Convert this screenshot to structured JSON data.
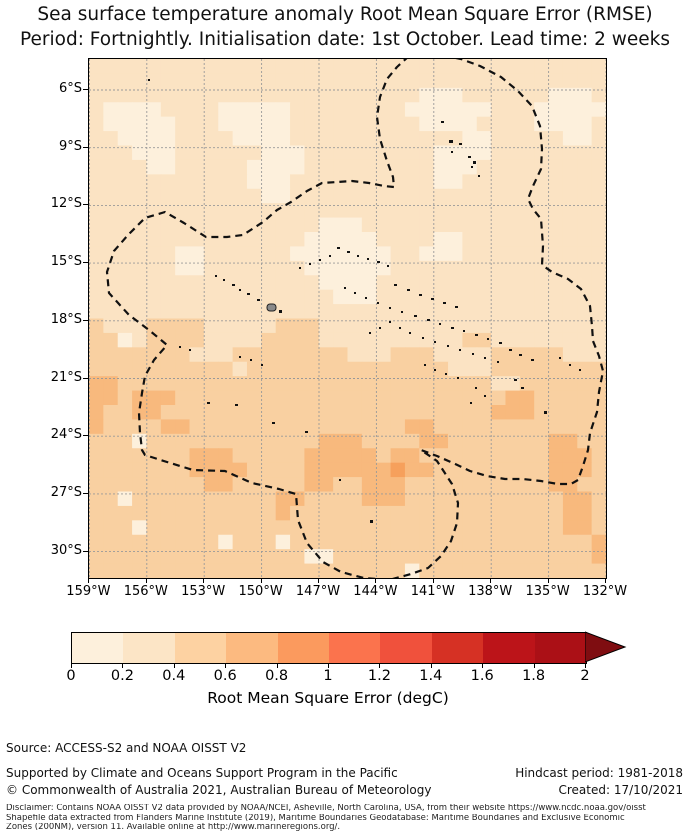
{
  "title": {
    "line1": "Sea surface temperature anomaly Root Mean Square Error (RMSE)",
    "line2": "Period: Fortnightly. Initialisation date: 1st October. Lead time: 2 weeks"
  },
  "map": {
    "y_ticks": [
      "6°S",
      "9°S",
      "12°S",
      "15°S",
      "18°S",
      "21°S",
      "24°S",
      "27°S",
      "30°S"
    ],
    "x_ticks": [
      "159°W",
      "156°W",
      "153°W",
      "150°W",
      "147°W",
      "144°W",
      "141°W",
      "138°W",
      "135°W",
      "132°W"
    ],
    "grid_color": "#999999",
    "border_color": "#000000",
    "island_color": "#111111",
    "tahiti": [
      178,
      245,
      9,
      7
    ],
    "tahiti_color": "#8a8a8a",
    "eez_dash_color": "#111111",
    "islands": [
      [
        59,
        20,
        2,
        2
      ],
      [
        352,
        62,
        3,
        2
      ],
      [
        360,
        81,
        4,
        3
      ],
      [
        370,
        84,
        3,
        2
      ],
      [
        362,
        92,
        2,
        2
      ],
      [
        379,
        97,
        3,
        2
      ],
      [
        384,
        102,
        3,
        3
      ],
      [
        382,
        107,
        2,
        2
      ],
      [
        389,
        116,
        2,
        2
      ],
      [
        248,
        188,
        3,
        2
      ],
      [
        258,
        192,
        3,
        2
      ],
      [
        268,
        196,
        2,
        2
      ],
      [
        278,
        199,
        2,
        2
      ],
      [
        288,
        202,
        3,
        2
      ],
      [
        298,
        206,
        2,
        2
      ],
      [
        240,
        196,
        2,
        2
      ],
      [
        230,
        200,
        2,
        2
      ],
      [
        220,
        204,
        2,
        2
      ],
      [
        210,
        208,
        2,
        2
      ],
      [
        126,
        216,
        2,
        2
      ],
      [
        134,
        220,
        2,
        2
      ],
      [
        143,
        225,
        3,
        2
      ],
      [
        150,
        230,
        2,
        2
      ],
      [
        158,
        234,
        3,
        2
      ],
      [
        168,
        240,
        3,
        2
      ],
      [
        190,
        251,
        3,
        3
      ],
      [
        305,
        225,
        3,
        2
      ],
      [
        318,
        230,
        3,
        2
      ],
      [
        330,
        235,
        3,
        2
      ],
      [
        342,
        239,
        3,
        2
      ],
      [
        354,
        243,
        3,
        2
      ],
      [
        366,
        247,
        3,
        2
      ],
      [
        255,
        228,
        2,
        2
      ],
      [
        265,
        233,
        2,
        2
      ],
      [
        276,
        238,
        2,
        2
      ],
      [
        288,
        243,
        2,
        2
      ],
      [
        300,
        248,
        2,
        2
      ],
      [
        312,
        252,
        2,
        2
      ],
      [
        325,
        256,
        3,
        2
      ],
      [
        338,
        260,
        3,
        2
      ],
      [
        350,
        264,
        2,
        2
      ],
      [
        362,
        268,
        3,
        2
      ],
      [
        374,
        271,
        2,
        2
      ],
      [
        386,
        275,
        3,
        2
      ],
      [
        398,
        279,
        2,
        2
      ],
      [
        410,
        283,
        3,
        2
      ],
      [
        300,
        262,
        2,
        2
      ],
      [
        290,
        268,
        2,
        2
      ],
      [
        280,
        273,
        2,
        2
      ],
      [
        310,
        268,
        2,
        2
      ],
      [
        320,
        273,
        2,
        2
      ],
      [
        333,
        278,
        2,
        2
      ],
      [
        345,
        282,
        2,
        2
      ],
      [
        358,
        286,
        2,
        2
      ],
      [
        370,
        290,
        2,
        2
      ],
      [
        383,
        294,
        2,
        2
      ],
      [
        395,
        298,
        2,
        2
      ],
      [
        408,
        302,
        2,
        2
      ],
      [
        420,
        290,
        3,
        2
      ],
      [
        430,
        295,
        3,
        2
      ],
      [
        442,
        300,
        3,
        2
      ],
      [
        161,
        300,
        2,
        2
      ],
      [
        172,
        305,
        2,
        2
      ],
      [
        150,
        297,
        2,
        2
      ],
      [
        100,
        290,
        2,
        2
      ],
      [
        90,
        287,
        2,
        2
      ],
      [
        480,
        305,
        2,
        2
      ],
      [
        490,
        310,
        2,
        2
      ],
      [
        470,
        298,
        2,
        2
      ],
      [
        345,
        310,
        2,
        2
      ],
      [
        356,
        314,
        2,
        2
      ],
      [
        335,
        305,
        2,
        2
      ],
      [
        368,
        318,
        2,
        2
      ],
      [
        425,
        320,
        3,
        2
      ],
      [
        432,
        328,
        3,
        2
      ],
      [
        386,
        328,
        2,
        2
      ],
      [
        395,
        336,
        2,
        2
      ],
      [
        381,
        343,
        2,
        2
      ],
      [
        455,
        352,
        3,
        3
      ],
      [
        118,
        343,
        3,
        2
      ],
      [
        146,
        345,
        3,
        2
      ],
      [
        183,
        363,
        3,
        2
      ],
      [
        216,
        372,
        3,
        2
      ],
      [
        281,
        461,
        3,
        3
      ],
      [
        250,
        420,
        2,
        2
      ]
    ],
    "eez_boundary": [
      [
        320,
        -3
      ],
      [
        308,
        8
      ],
      [
        298,
        20
      ],
      [
        291,
        38
      ],
      [
        288,
        58
      ],
      [
        291,
        80
      ],
      [
        298,
        102
      ],
      [
        304,
        118
      ],
      [
        305,
        128
      ],
      [
        295,
        127
      ],
      [
        280,
        124
      ],
      [
        263,
        122
      ],
      [
        248,
        123
      ],
      [
        233,
        124
      ],
      [
        218,
        132
      ],
      [
        202,
        143
      ],
      [
        188,
        151
      ],
      [
        174,
        163
      ],
      [
        154,
        176
      ],
      [
        138,
        178
      ],
      [
        117,
        178
      ],
      [
        95,
        164
      ],
      [
        76,
        153
      ],
      [
        56,
        159
      ],
      [
        39,
        176
      ],
      [
        25,
        192
      ],
      [
        18,
        213
      ],
      [
        20,
        234
      ],
      [
        40,
        256
      ],
      [
        60,
        271
      ],
      [
        78,
        286
      ],
      [
        65,
        301
      ],
      [
        56,
        317
      ],
      [
        53,
        334
      ],
      [
        50,
        354
      ],
      [
        51,
        374
      ],
      [
        53,
        391
      ],
      [
        56,
        396
      ],
      [
        78,
        403
      ],
      [
        104,
        411
      ],
      [
        136,
        412
      ],
      [
        163,
        424
      ],
      [
        190,
        430
      ],
      [
        207,
        435
      ],
      [
        209,
        461
      ],
      [
        218,
        484
      ],
      [
        234,
        503
      ],
      [
        252,
        513
      ],
      [
        275,
        519
      ],
      [
        300,
        521
      ],
      [
        322,
        515
      ],
      [
        339,
        509
      ],
      [
        352,
        497
      ],
      [
        362,
        482
      ],
      [
        368,
        464
      ],
      [
        369,
        444
      ],
      [
        363,
        425
      ],
      [
        348,
        402
      ],
      [
        332,
        391
      ],
      [
        348,
        397
      ],
      [
        364,
        404
      ],
      [
        381,
        412
      ],
      [
        398,
        417
      ],
      [
        416,
        420
      ],
      [
        434,
        420
      ],
      [
        452,
        422
      ],
      [
        469,
        425
      ],
      [
        482,
        425
      ],
      [
        489,
        421
      ],
      [
        494,
        407
      ],
      [
        499,
        391
      ],
      [
        501,
        374
      ],
      [
        508,
        353
      ],
      [
        510,
        333
      ],
      [
        514,
        312
      ],
      [
        510,
        297
      ],
      [
        504,
        282
      ],
      [
        503,
        267
      ],
      [
        501,
        247
      ],
      [
        492,
        230
      ],
      [
        479,
        220
      ],
      [
        463,
        213
      ],
      [
        453,
        206
      ],
      [
        454,
        187
      ],
      [
        452,
        160
      ],
      [
        444,
        150
      ],
      [
        439,
        140
      ],
      [
        444,
        127
      ],
      [
        452,
        110
      ],
      [
        453,
        90
      ],
      [
        451,
        67
      ],
      [
        443,
        47
      ],
      [
        429,
        32
      ],
      [
        412,
        18
      ],
      [
        391,
        7
      ],
      [
        372,
        0
      ],
      [
        352,
        -4
      ]
    ]
  },
  "colorbar": {
    "ticks": [
      "0",
      "0.2",
      "0.4",
      "0.6",
      "0.8",
      "1",
      "1.2",
      "1.4",
      "1.6",
      "1.8",
      "2"
    ],
    "colors": [
      "#fdf0dc",
      "#fce5c6",
      "#fdd2a2",
      "#fcba80",
      "#fb9a5e",
      "#fb734d",
      "#f0513c",
      "#d63124",
      "#bc1419",
      "#ab1016"
    ],
    "arrow_color": "#7f0d11",
    "label": "Root Mean Square Error (degC)"
  },
  "footer": {
    "source": "Source: ACCESS-S2 and NOAA OISST V2",
    "supported": "Supported by Climate and Oceans Support Program in the Pacific",
    "copyright": "© Commonwealth of Australia 2021, Australian Bureau of Meteorology",
    "hindcast": "Hindcast period: 1981-2018",
    "created": "Created: 17/10/2021",
    "disclaimer1": "Disclaimer: Contains NOAA OISST V2 data provided by NOAA/NCEI, Asheville, North Carolina, USA, from their website https://www.ncdc.noaa.gov/oisst",
    "disclaimer2": "Shapefile data extracted from Flanders Marine Institute (2019), Maritime Boundaries Geodatabase: Maritime Boundaries and Exclusive Economic",
    "disclaimer3": "Zones (200NM), version 11. Available online at http://www.marineregions.org/."
  },
  "chart_data": {
    "type": "heatmap",
    "title": "Sea surface temperature anomaly Root Mean Square Error (RMSE)",
    "subtitle": "Period: Fortnightly. Initialisation date: 1st October. Lead time: 2 weeks",
    "variable": "Root Mean Square Error (degC)",
    "region": "French Polynesia EEZ, South Pacific",
    "xlabel_ticks": [
      "159°W",
      "156°W",
      "153°W",
      "150°W",
      "147°W",
      "144°W",
      "141°W",
      "138°W",
      "135°W",
      "132°W"
    ],
    "ylabel_ticks": [
      "6°S",
      "9°S",
      "12°S",
      "15°S",
      "18°S",
      "21°S",
      "24°S",
      "27°S",
      "30°S"
    ],
    "lon_range": [
      "159°W",
      "132°W"
    ],
    "lat_range": [
      "4.4°S",
      "31.4°S"
    ],
    "colorbar_range": [
      0,
      2
    ],
    "colorbar_step": 0.2,
    "colorbar_extend_max": true,
    "grid_on": true,
    "legend_position": "bottom colorbar",
    "value_bins_degC": {
      "0": "0.0-0.2",
      "1": "0.2-0.4",
      "2": "0.4-0.6",
      "3": "0.6-0.8",
      "4": "0.8-1.0"
    },
    "summary": "RMSE is ~0.2-0.4 degC north of ~19°S with patches of 0.0-0.2, and ~0.4-0.6 degC south of ~19°S with scattered 0.6-0.8 patches.",
    "grid_rows": [
      "111111111111111111111111111111111111",
      "111111111111111111111111111111111111",
      "111111111111111111111110001111110001",
      "100001111000001111111100000011100000",
      "100000111000001111111110000111100001",
      "110000111100001111111111110011111001",
      "111000111111000111111111000011111111",
      "111100111110000111111111000111111111",
      "111111111110001111111111001111111111",
      "111111111111001111111111111111111111",
      "111111111111111111111111111111111111",
      "111111111111111100011111111111111111",
      "111111111111111000001111001111111111",
      "111111001111110000000110001111111111",
      "111111001111111000000111111111111111",
      "111111111111111100001111111111111111",
      "111111111111111110001111111111111111",
      "111111111111111111111111111111111111",
      "211122221111122211111111111111111111",
      "220122221111222211111111112211111111",
      "222222211122222222111222111122222111",
      "222222222212222222222222211122222222",
      "332222222222222222222222222211222222",
      "332333222222222222222222222223322222",
      "322332222222222222222222222233322222",
      "322223322222222222222233222222222222",
      "222022222222222233322223322222223322",
      "222222233322222333332332222222223332",
      "222222233332222333333433222222223332",
      "222222223322222332233322222222223322",
      "220222222222233222233322222222222332",
      "222222222222232222222222222222222332",
      "222022222222222222222222222222222332",
      "222222222022202222222222222222222223",
      "222222222222222002222222222222222223",
      "222222222222222222222202222222222222"
    ],
    "palette": {
      "0": "#fdf0dc",
      "1": "#fbe3c3",
      "2": "#f9d0a1",
      "3": "#f8b97d",
      "4": "#f6a05c"
    }
  }
}
